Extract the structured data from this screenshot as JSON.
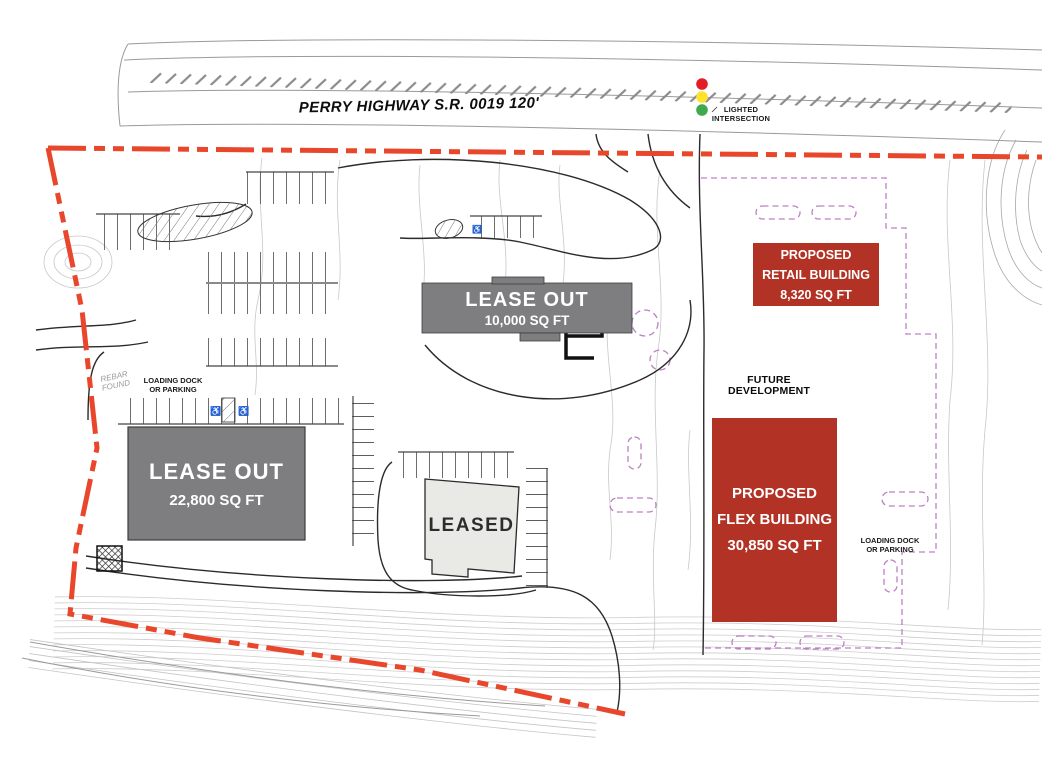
{
  "highway": {
    "label": "PERRY HIGHWAY S.R. 0019  120'"
  },
  "intersection": {
    "line1": "LIGHTED",
    "line2": "INTERSECTION"
  },
  "buildings": {
    "lease10": {
      "name": "LEASE OUT",
      "size": "10,000 SQ FT"
    },
    "lease22": {
      "name": "LEASE OUT",
      "size": "22,800 SQ FT"
    },
    "leased": {
      "name": "LEASED"
    },
    "retail": {
      "line1": "PROPOSED",
      "line2": "RETAIL BUILDING",
      "line3": "8,320 SQ FT"
    },
    "flex": {
      "line1": "PROPOSED",
      "line2": "FLEX BUILDING",
      "line3": "30,850 SQ FT"
    }
  },
  "annotations": {
    "future_dev": {
      "line1": "FUTURE",
      "line2": "DEVELOPMENT"
    },
    "loading_left": {
      "line1": "LOADING DOCK",
      "line2": "OR PARKING"
    },
    "loading_right": {
      "line1": "LOADING DOCK",
      "line2": "OR PARKING"
    },
    "rebar": {
      "line1": "REBAR",
      "line2": "FOUND"
    }
  },
  "icons": {
    "accessible": "♿",
    "traffic_signal": "traffic-light-icon"
  },
  "colors": {
    "boundary": "#E8472B",
    "building_gray": "#7E7E80",
    "building_leased": "#E9E9E6",
    "building_proposed": "#B23325",
    "future_parking": "#BD7FC4",
    "signal_red": "#E01F26",
    "signal_yellow": "#FFE32A",
    "signal_green": "#3FA94C"
  }
}
